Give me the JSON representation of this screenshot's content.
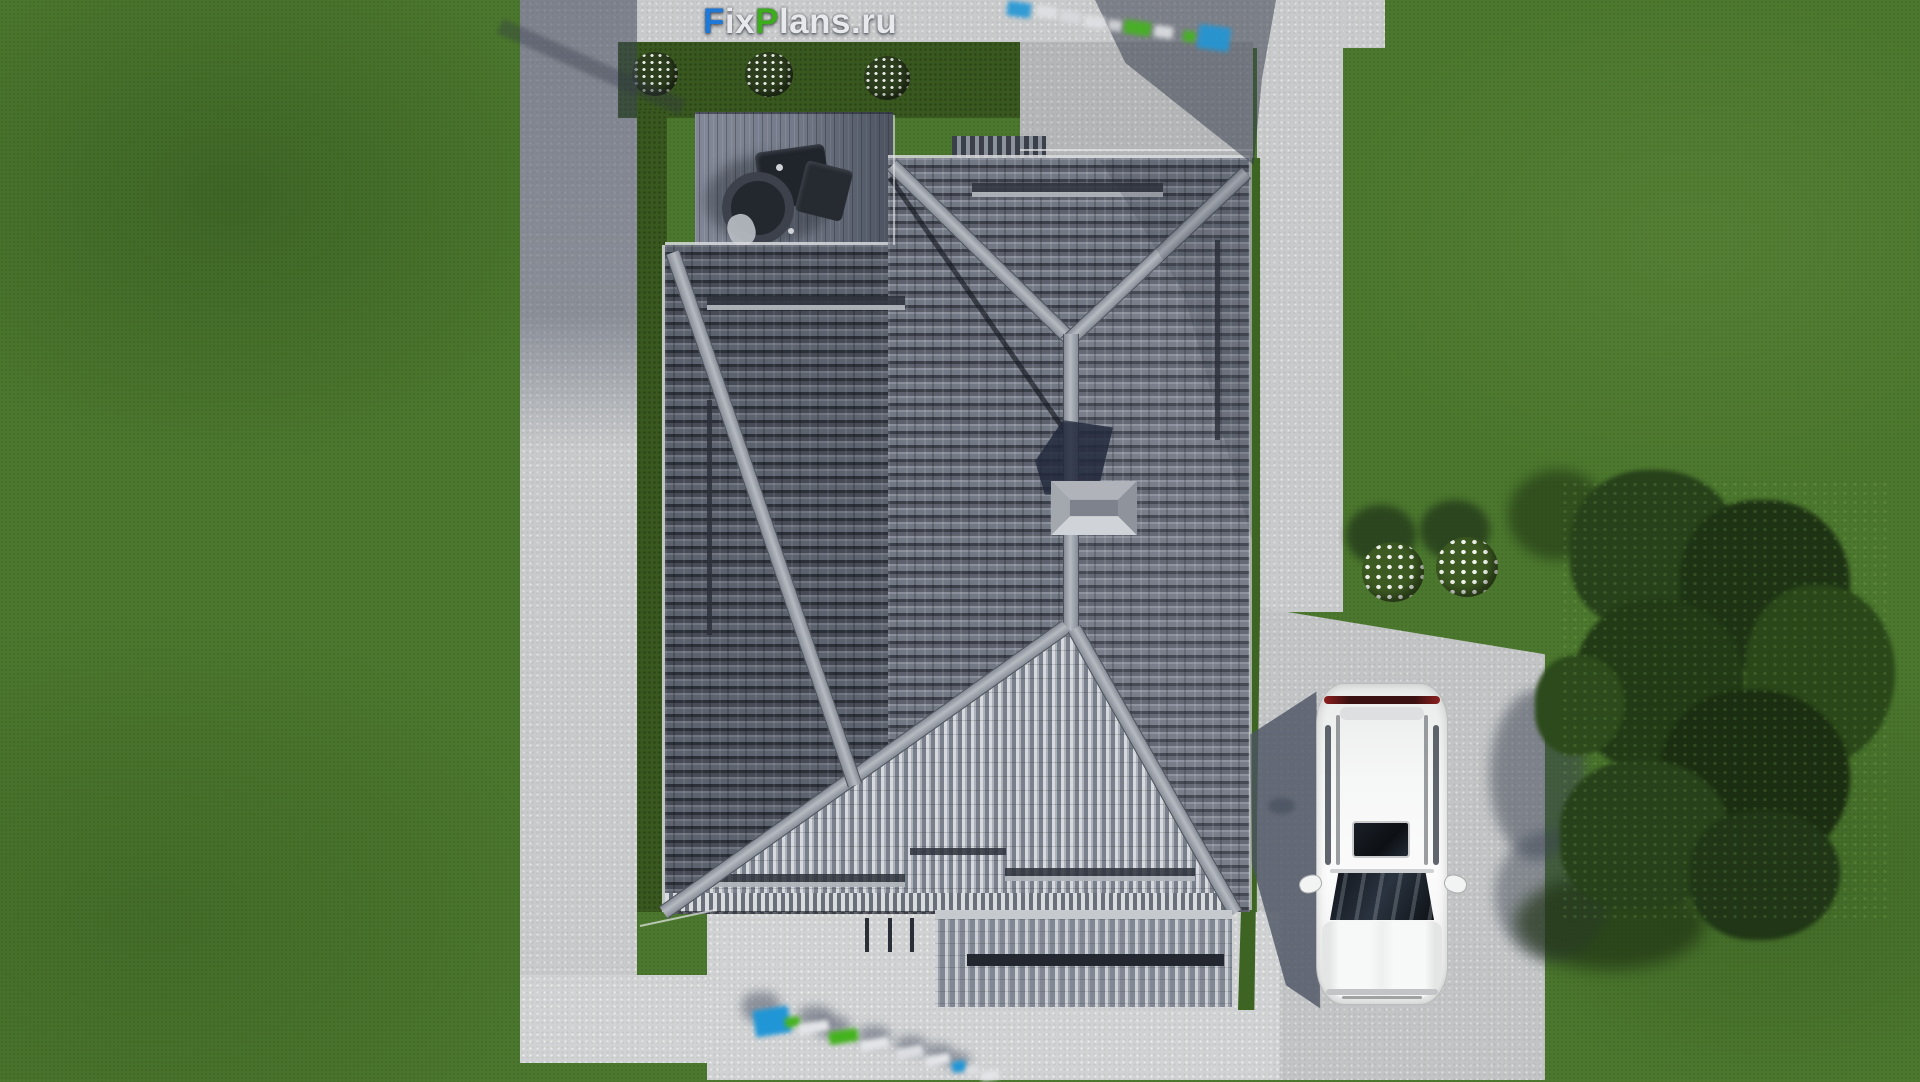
{
  "watermark_logo": {
    "segments": [
      {
        "text": "F",
        "color": "#1e78d8"
      },
      {
        "text": "ix",
        "color": "#e8e9ec"
      },
      {
        "text": "P",
        "color": "#3dad1d"
      },
      {
        "text": "lans.ru",
        "color": "#e8e9ec"
      }
    ],
    "full_text": "FixPlans.ru"
  },
  "ground_watermarks": {
    "top_right": {
      "represents": "FixPlans.ru",
      "style": "blurred extruded blocks on pavement"
    },
    "bottom_left": {
      "represents": "FixPlans.ru",
      "style": "blurred extruded blocks on pavement"
    }
  },
  "palette": {
    "grass": "#4c782e",
    "hedge_strip": "#39581f",
    "concrete": "#c8cacb",
    "roof_dark_slope": "#575d69",
    "roof_mid_slope": "#6d7380",
    "roof_bright_slope": "#c9ced6",
    "ridge_cap": "#aab0b8",
    "shadow_blue": "#2f3545",
    "logo_blue": "#1e78d8",
    "logo_green": "#3dad1d",
    "logo_white": "#e8e9ec",
    "car_body": "#f4f5f5",
    "taillight_red": "#7e1d1d",
    "tree_foliage": "#1e3314",
    "flower_white": "#eef2ea"
  }
}
